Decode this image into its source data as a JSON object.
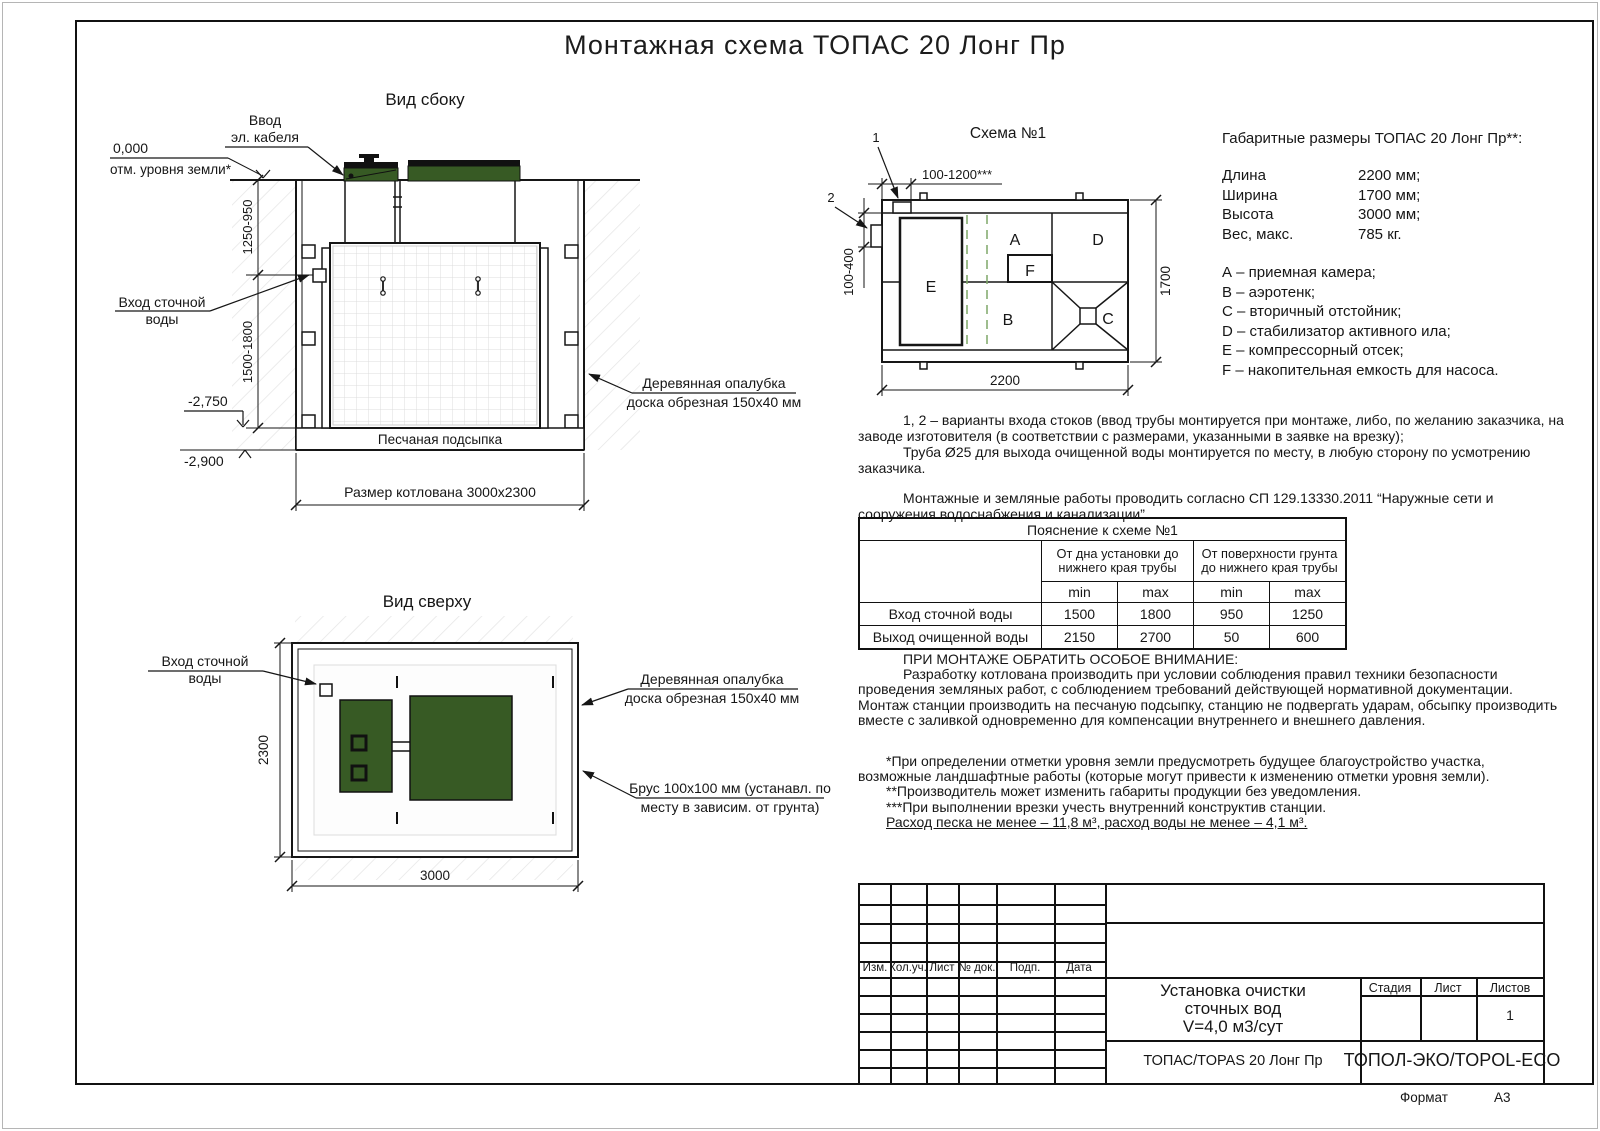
{
  "page": {
    "title": "Монтажная схема ТОПАС 20 Лонг Пр",
    "format_label": "Формат",
    "format_value": "А3"
  },
  "side_view": {
    "title": "Вид сбоку",
    "cable_label": [
      "Ввод",
      "эл. кабеля"
    ],
    "zero_mark": "0,000",
    "zero_note": "отм. уровня земли*",
    "inlet_label": [
      "Вход сточной",
      "воды"
    ],
    "dim_upper": "1250-950",
    "dim_lower": "1500-1800",
    "level_pit": "-2,750",
    "level_sand": "-2,900",
    "sand_label": "Песчаная подсыпка",
    "pit_size": "Размер котлована 3000х2300",
    "formwork_label": [
      "Деревянная опалубка",
      "доска обрезная 150х40 мм"
    ]
  },
  "top_view": {
    "title": "Вид сверху",
    "inlet_label": [
      "Вход сточной",
      "воды"
    ],
    "dim_left": "2300",
    "dim_bottom": "3000",
    "formwork_label": [
      "Деревянная опалубка",
      "доска обрезная 150х40 мм"
    ],
    "beam_label": [
      "Брус 100х100 мм (устанавл. по",
      "месту в зависим. от грунта)"
    ]
  },
  "schema": {
    "title": "Схема №1",
    "marker_1": "1",
    "marker_2": "2",
    "dim_top": "100-1200***",
    "dim_side": "100-400",
    "dim_width": "2200",
    "dim_height": "1700",
    "sections": {
      "a": "A",
      "b": "B",
      "c": "C",
      "d": "D",
      "e": "E",
      "f": "F"
    }
  },
  "specs": {
    "title": "Габаритные размеры ТОПАС 20 Лонг Пр**:",
    "rows": [
      {
        "label": "Длина",
        "value": "2200 мм;"
      },
      {
        "label": "Ширина",
        "value": "1700 мм;"
      },
      {
        "label": "Высота",
        "value": "3000 мм;"
      },
      {
        "label": "Вес, макс.",
        "value": "785 кг."
      }
    ],
    "legend": [
      "А – приемная камера;",
      "В – аэротенк;",
      "С – вторичный отстойник;",
      "D – стабилизатор активного ила;",
      "Е – компрессорный отсек;",
      "F – накопительная емкость для насоса."
    ]
  },
  "notes": {
    "variants": "1, 2 – варианты входа  стоков (ввод трубы монтируется при монтаже, либо, по желанию заказчика, на заводе изготовителя (в соответствии с размерами, указанными в заявке на врезку);",
    "pipe": "Труба Ø25 для выхода очищенной воды монтируется по месту, в любую сторону по усмотрению заказчика.",
    "works": "Монтажные и земляные работы проводить согласно СП 129.13330.2011 “Наружные сети и сооружения водоснабжения и канализации”."
  },
  "table": {
    "caption": "Пояснение к схеме №1",
    "col_group_1": [
      "От дна установки до",
      "нижнего края трубы"
    ],
    "col_group_2": [
      "От поверхности грунта",
      "до нижнего края трубы"
    ],
    "min_label": "min",
    "max_label": "max",
    "rows": [
      {
        "name": "Вход сточной воды",
        "values": [
          "1500",
          "1800",
          "950",
          "1250"
        ]
      },
      {
        "name": "Выход очищенной воды",
        "values": [
          "2150",
          "2700",
          "50",
          "600"
        ]
      }
    ]
  },
  "attention": {
    "heading": "ПРИ МОНТАЖЕ ОБРАТИТЬ ОСОБОЕ ВНИМАНИЕ:",
    "body": "Разработку котлована производить при условии соблюдения правил техники безопасности проведения земляных работ, с соблюдением требований действующей нормативной документации. Монтаж станции производить на песчаную подсыпку, станцию не подвергать ударам, обсыпку производить вместе с заливкой одновременно для компенсации внутреннего и внешнего давления.",
    "note_1": "*При определении отметки уровня земли предусмотреть будущее благоустройство участка, возможные ландшафтные работы (которые могут привести к изменению отметки уровня земли).",
    "note_2": "**Производитель может изменить габариты продукции без уведомления.",
    "note_3": "***При выполнении врезки учесть внутренний конструктив станции.",
    "consumption": "Расход песка не менее – 11,8 м³, расход воды не менее – 4,1 м³."
  },
  "stamp": {
    "rev_headers": [
      "Изм.",
      "Кол.уч.",
      "Лист",
      "№ док.",
      "Подп.",
      "Дата"
    ],
    "doc_title": [
      "Установка очистки",
      "сточных вод",
      "V=4,0 м3/сут"
    ],
    "product": "ТОПАС/TOPAS 20 Лонг Пр",
    "stage_label": "Стадия",
    "sheet_label": "Лист",
    "sheets_label": "Листов",
    "sheets_value": "1",
    "company": "ТОПОЛ-ЭКО/TOPOL-ECO"
  },
  "colors": {
    "lid_green": "#375a24",
    "dashed_green": "#7fa768"
  }
}
